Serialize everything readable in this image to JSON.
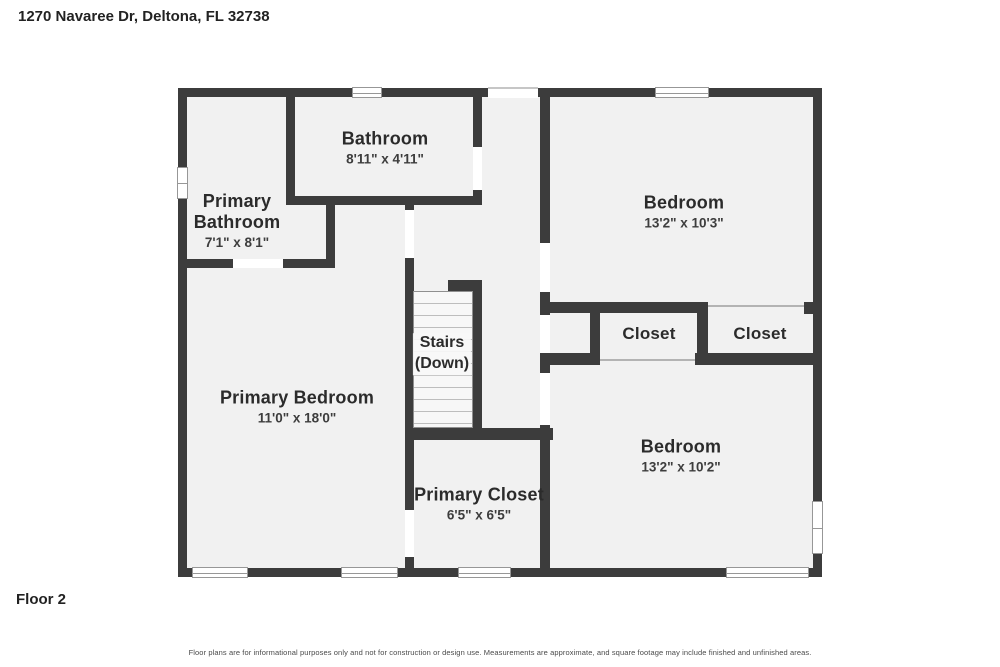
{
  "page": {
    "address": "1270 Navaree Dr, Deltona, FL 32738",
    "floor_label": "Floor 2",
    "disclaimer": "Floor plans are for informational purposes only and not for construction or design use. Measurements are approximate, and square footage may include finished and unfinished areas."
  },
  "colors": {
    "wall": "#3c3c3c",
    "room_fill": "#f1f1f1",
    "door_gap": "#ffffff",
    "thin_line": "#b3b3b3",
    "window_frame": "#979797",
    "label_text": "#2b2b2b"
  },
  "rooms": {
    "bathroom": {
      "name": "Bathroom",
      "dims": "8'11\" x 4'11\""
    },
    "primary_bathroom": {
      "name": "Primary Bathroom",
      "dims": "7'1\" x 8'1\""
    },
    "bedroom_top": {
      "name": "Bedroom",
      "dims": "13'2\" x 10'3\""
    },
    "closet_left": {
      "name": "Closet"
    },
    "closet_right": {
      "name": "Closet"
    },
    "stairs": {
      "name": "Stairs",
      "direction": "(Down)"
    },
    "primary_bedroom": {
      "name": "Primary Bedroom",
      "dims": "11'0\" x 18'0\""
    },
    "primary_closet": {
      "name": "Primary Closet",
      "dims": "6'5\" x 6'5\""
    },
    "bedroom_bottom": {
      "name": "Bedroom",
      "dims": "13'2\" x 10'2\""
    }
  }
}
